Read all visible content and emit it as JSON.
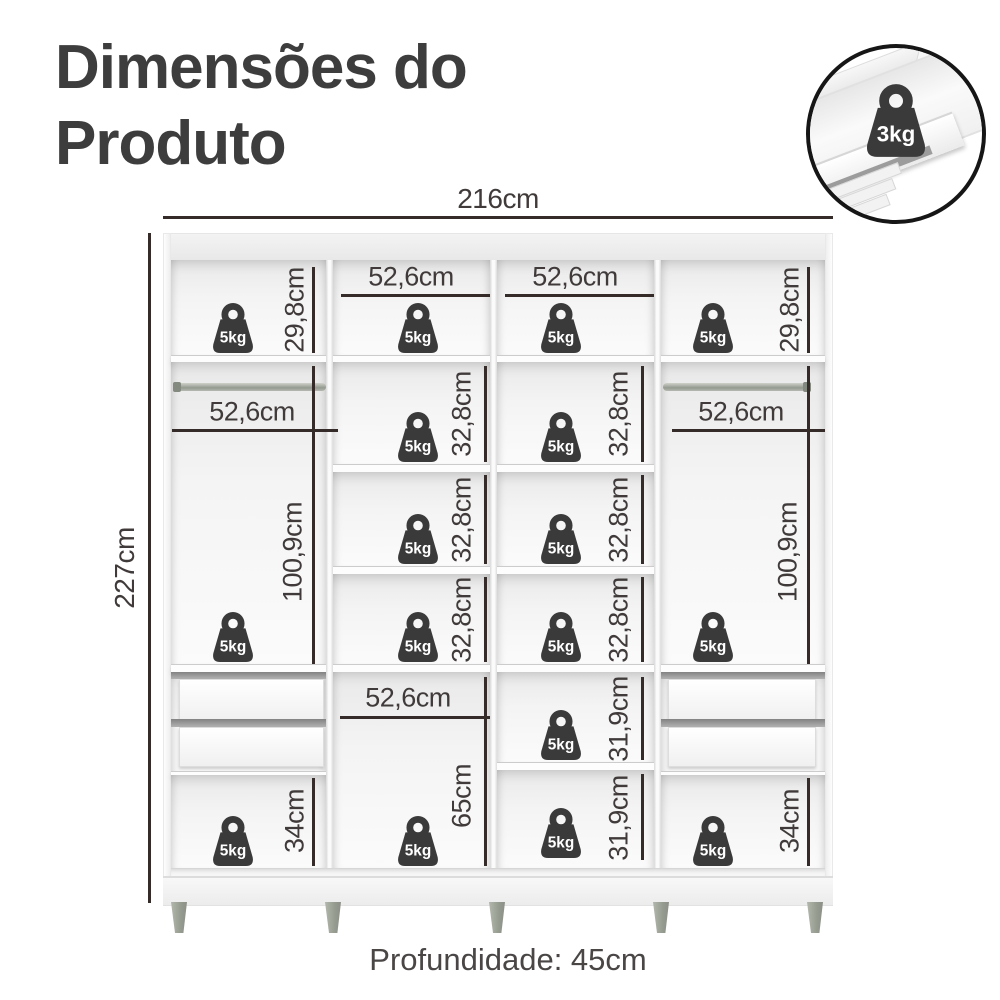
{
  "title": {
    "line1": "Dimensões do",
    "line2": "Produto"
  },
  "overall": {
    "width_label": "216cm",
    "height_label": "227cm",
    "depth_label": "Profundidade: 45cm"
  },
  "inset": {
    "weight_label": "3kg"
  },
  "weight_label": "5kg",
  "measurements": {
    "top_left_height": "29,8cm",
    "top_right_height": "29,8cm",
    "top_c2_width": "52,6cm",
    "top_c3_width": "52,6cm",
    "hang_left_width": "52,6cm",
    "hang_right_width": "52,6cm",
    "hang_left_height": "100,9cm",
    "hang_right_height": "100,9cm",
    "c2_shelf1_height": "32,8cm",
    "c2_shelf2_height": "32,8cm",
    "c2_shelf3_height": "32,8cm",
    "c3_shelf1_height": "32,8cm",
    "c3_shelf2_height": "32,8cm",
    "c3_shelf3_height": "32,8cm",
    "c2_lower_width": "52,6cm",
    "c2_lower_height": "65cm",
    "c3_lower1_height": "31,9cm",
    "c3_lower2_height": "31,9cm",
    "bottom_left_height": "34cm",
    "bottom_right_height": "34cm"
  },
  "colors": {
    "c-line": "#352b28",
    "c-text": "#403b3a",
    "c-title": "#3d3d3d",
    "c-weight": "#3a3a3a",
    "c-leg": "#989d92",
    "c-depth": "#4a4646",
    "c-inset-border": "#161616"
  }
}
